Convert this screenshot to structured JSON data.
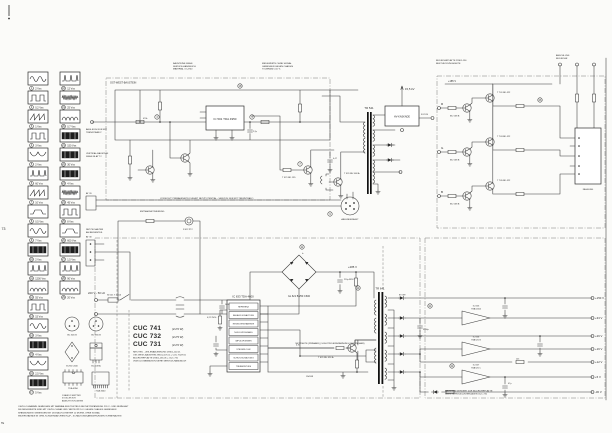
{
  "page": {
    "bg": "#fbfbf9",
    "ink": "#3a3a3a"
  },
  "marks": {
    "page_number": "73",
    "corner": "TE"
  },
  "title_block": {
    "models": [
      {
        "name": "CUC 741",
        "detail": "(2x70 W)"
      },
      {
        "name": "CUC 732",
        "detail": "(2x75 W)"
      },
      {
        "name": "CUC 731",
        "detail": "(2x70 W)"
      }
    ],
    "lines": [
      "NETZTEIL - ZEILENABLENKUNG  29301-102.21",
      "OST-WEST-BAUSTEIN  29301-107.01   = CUC 732/741",
      "BILDROHRPLATTE  29301-156.05      = CUC 731",
      "VIDEO-KOMBINATION  SIEHE SERVICE-HANDBUCH"
    ]
  },
  "waveforms": {
    "col1": [
      {
        "num": "1",
        "label": "2 Vss"
      },
      {
        "num": "2",
        "label": "0,2 Vss"
      },
      {
        "num": "3",
        "label": "1 Vss"
      },
      {
        "num": "4",
        "label": "3 Vss"
      },
      {
        "num": "5",
        "label": "2 Vss"
      },
      {
        "num": "6",
        "label": "60 Vss"
      },
      {
        "num": "7",
        "label": "10 Vss"
      },
      {
        "num": "8",
        "label": "0,5 Vss"
      },
      {
        "num": "9",
        "label": "7 Vss"
      },
      {
        "num": "10",
        "label": "2 Vss"
      },
      {
        "num": "11",
        "label": "1200 Vss"
      },
      {
        "num": "12",
        "label": "55 Vss"
      },
      {
        "num": "13",
        "label": "15 Vss"
      },
      {
        "num": "14",
        "label": "3 Vss"
      },
      {
        "num": "15",
        "label": "4 Vss"
      },
      {
        "num": "16",
        "label": "2,5 Vss"
      },
      {
        "num": "17",
        "label": "5 Vss"
      }
    ],
    "col2": [
      {
        "num": "18",
        "label": "12 Vss"
      },
      {
        "num": "19",
        "label": "25 Vss"
      },
      {
        "num": "20",
        "label": "0,7 Vss"
      },
      {
        "num": "21",
        "label": "150 Vss"
      },
      {
        "num": "22",
        "label": "30 Vss"
      },
      {
        "num": "23",
        "label": "4 Vss"
      },
      {
        "num": "24",
        "label": "45 Vss"
      },
      {
        "num": "25",
        "label": "8 Vss"
      },
      {
        "num": "26",
        "label": "600 Vss"
      },
      {
        "num": "27",
        "label": "1,5 Vss"
      },
      {
        "num": "28",
        "label": "90 Vss"
      },
      {
        "num": "29",
        "label": "20 Vss"
      }
    ]
  },
  "pinouts": {
    "labels": [
      "BC 546 B",
      "BC 556 B",
      "B 250 C600",
      "BU 508 A",
      "TDA 4950",
      "TDA 4600"
    ],
    "notes": [
      "1 BASIS  2 EMITTER",
      "3 KOLLEKTOR",
      "ANSICHT VON UNTEN"
    ]
  },
  "schematic": {
    "components": {
      "ew_region": "OST-WEST-BAUSTEIN",
      "ew_ic": "IC 501  TDA 4950",
      "t_driver": "T 521  BD 135",
      "t_line": "T 531  BU 508 A",
      "flyback": "TR 541",
      "hv_block": "HV-KASKADE",
      "hv_kv": "15,5 kV",
      "focus": "FOCUS",
      "yoke_conn": "ABLENKEINHEIT",
      "degauss": "ENTMAGNETISIERUNG",
      "ptc": "R 622 PTC",
      "mains": "220 V~ 50 Hz",
      "fuse": "SI 621  T 2,5 A",
      "bridge": "GL 621  B 250 C600",
      "cap_primary": "+285 V",
      "smps_ic_title": "IC 633  TDA 4600",
      "smps_t": "T 631  BU 426 A",
      "smps_tr": "TR 641",
      "at_conn": "AT 30",
      "at_conn2": "AT 20",
      "video_rail": "+185 V",
      "crt_socket": "FASSUNG"
    },
    "smps_rows": [
      "REFERENZ",
      "ANLAUF-SCHALTUNG",
      "REGELVERSTAERKER",
      "NULLDURCHGANG",
      "IMPULSFORMER",
      "STEUERLOGIK",
      "SCHUTZSCHALTUNG",
      "TREIBERSTUFE"
    ],
    "rgb_channels": [
      {
        "id": "R",
        "drv": "BC 558 B",
        "out": "T 701  BF 422"
      },
      {
        "id": "G",
        "drv": "BC 558 B",
        "out": "T 703  BF 422"
      },
      {
        "id": "B",
        "drv": "BC 558 B",
        "out": "T 705  BF 422"
      }
    ],
    "regulators": [
      {
        "ref": "IC 655",
        "type": "TBA 625 A"
      },
      {
        "ref": "IC 656",
        "type": "TBA 625 B"
      },
      {
        "ref": "IC 657",
        "type": "TBA 625 C"
      }
    ],
    "rails": [
      "+150 V",
      "+33 V",
      "+26 V",
      "+16 V",
      "+12 V",
      "+5 V",
      "-30 V"
    ],
    "scope_refs": [
      "3",
      "5",
      "7",
      "9",
      "11",
      "14",
      "18",
      "21",
      "24",
      "26"
    ],
    "part_values": [
      "470k",
      "2,2µ",
      "0,47",
      "100n",
      "4,7k",
      "220µ 385V",
      "BY 399",
      "3300µ",
      "1k5",
      "0,22 250V~",
      "47µ",
      "1N4148"
    ],
    "notes": {
      "top": [
        [
          "BAUSTEINE SIEHE",
          "SERVICE-HANDBUCH",
          "MATERIAL 72-4700"
        ],
        [
          "MESSWERTE OHNE SIGNAL",
          "GEMESSEN GEGEN CHASSIS",
          "TOLERANZ ±10 %"
        ],
        [
          "BILDROHRPLATTE 29301-156",
          "BESTUECKUNGSSEITE"
        ],
        [
          "ANSCHLUSS",
          "BILDROHR"
        ]
      ],
      "left": [
        [
          "ABGLEICH NUR MIT",
          "TRENNTRAFO!"
        ],
        [
          "VERTIKAL-BAUSTEIN",
          "SIEHE BLATT 2"
        ],
        [
          "NETZSCHALTER",
          "AM BEDIENTEIL"
        ]
      ],
      "warn": "VORSICHT! PRIMAERSEITE FUEHRT NETZPOTENTIAL - SERVICE NUR MIT TRENNTRAFO",
      "separation": "NETZSEITE (PRIMAER)  |  SCHUTZKLEINSPANNUNG (SEKUNDAER)",
      "bottom_left": [
        "OSZILLOGRAMME GEMESSEN MIT FARBBALKEN-TESTBILD BEI NETZSPANNUNG 220 V~ UND NENNLAST",
        "DIE MESSWERTE SIND MIT OSZILLOGRAF UND TASTKOPF 10:1 GEGEN CHASSIS GEMESSEN",
        "SPANNUNGEN: GEMESSEN MIT DIGITALVOLTMETER 10 MOHM, OHNE SIGNAL",
        "WIDERSTAENDE IN OHM, KONDENSATOREN IN pF - SCHALTUNGSAENDERUNGEN VORBEHALTEN"
      ],
      "bottom_right": [
        "BAUSTEIN GEHOERT ZUR BILDROHRPLATTE",
        "SIEHE SERVICE-UNTERLAGEN CUC 720"
      ]
    }
  }
}
